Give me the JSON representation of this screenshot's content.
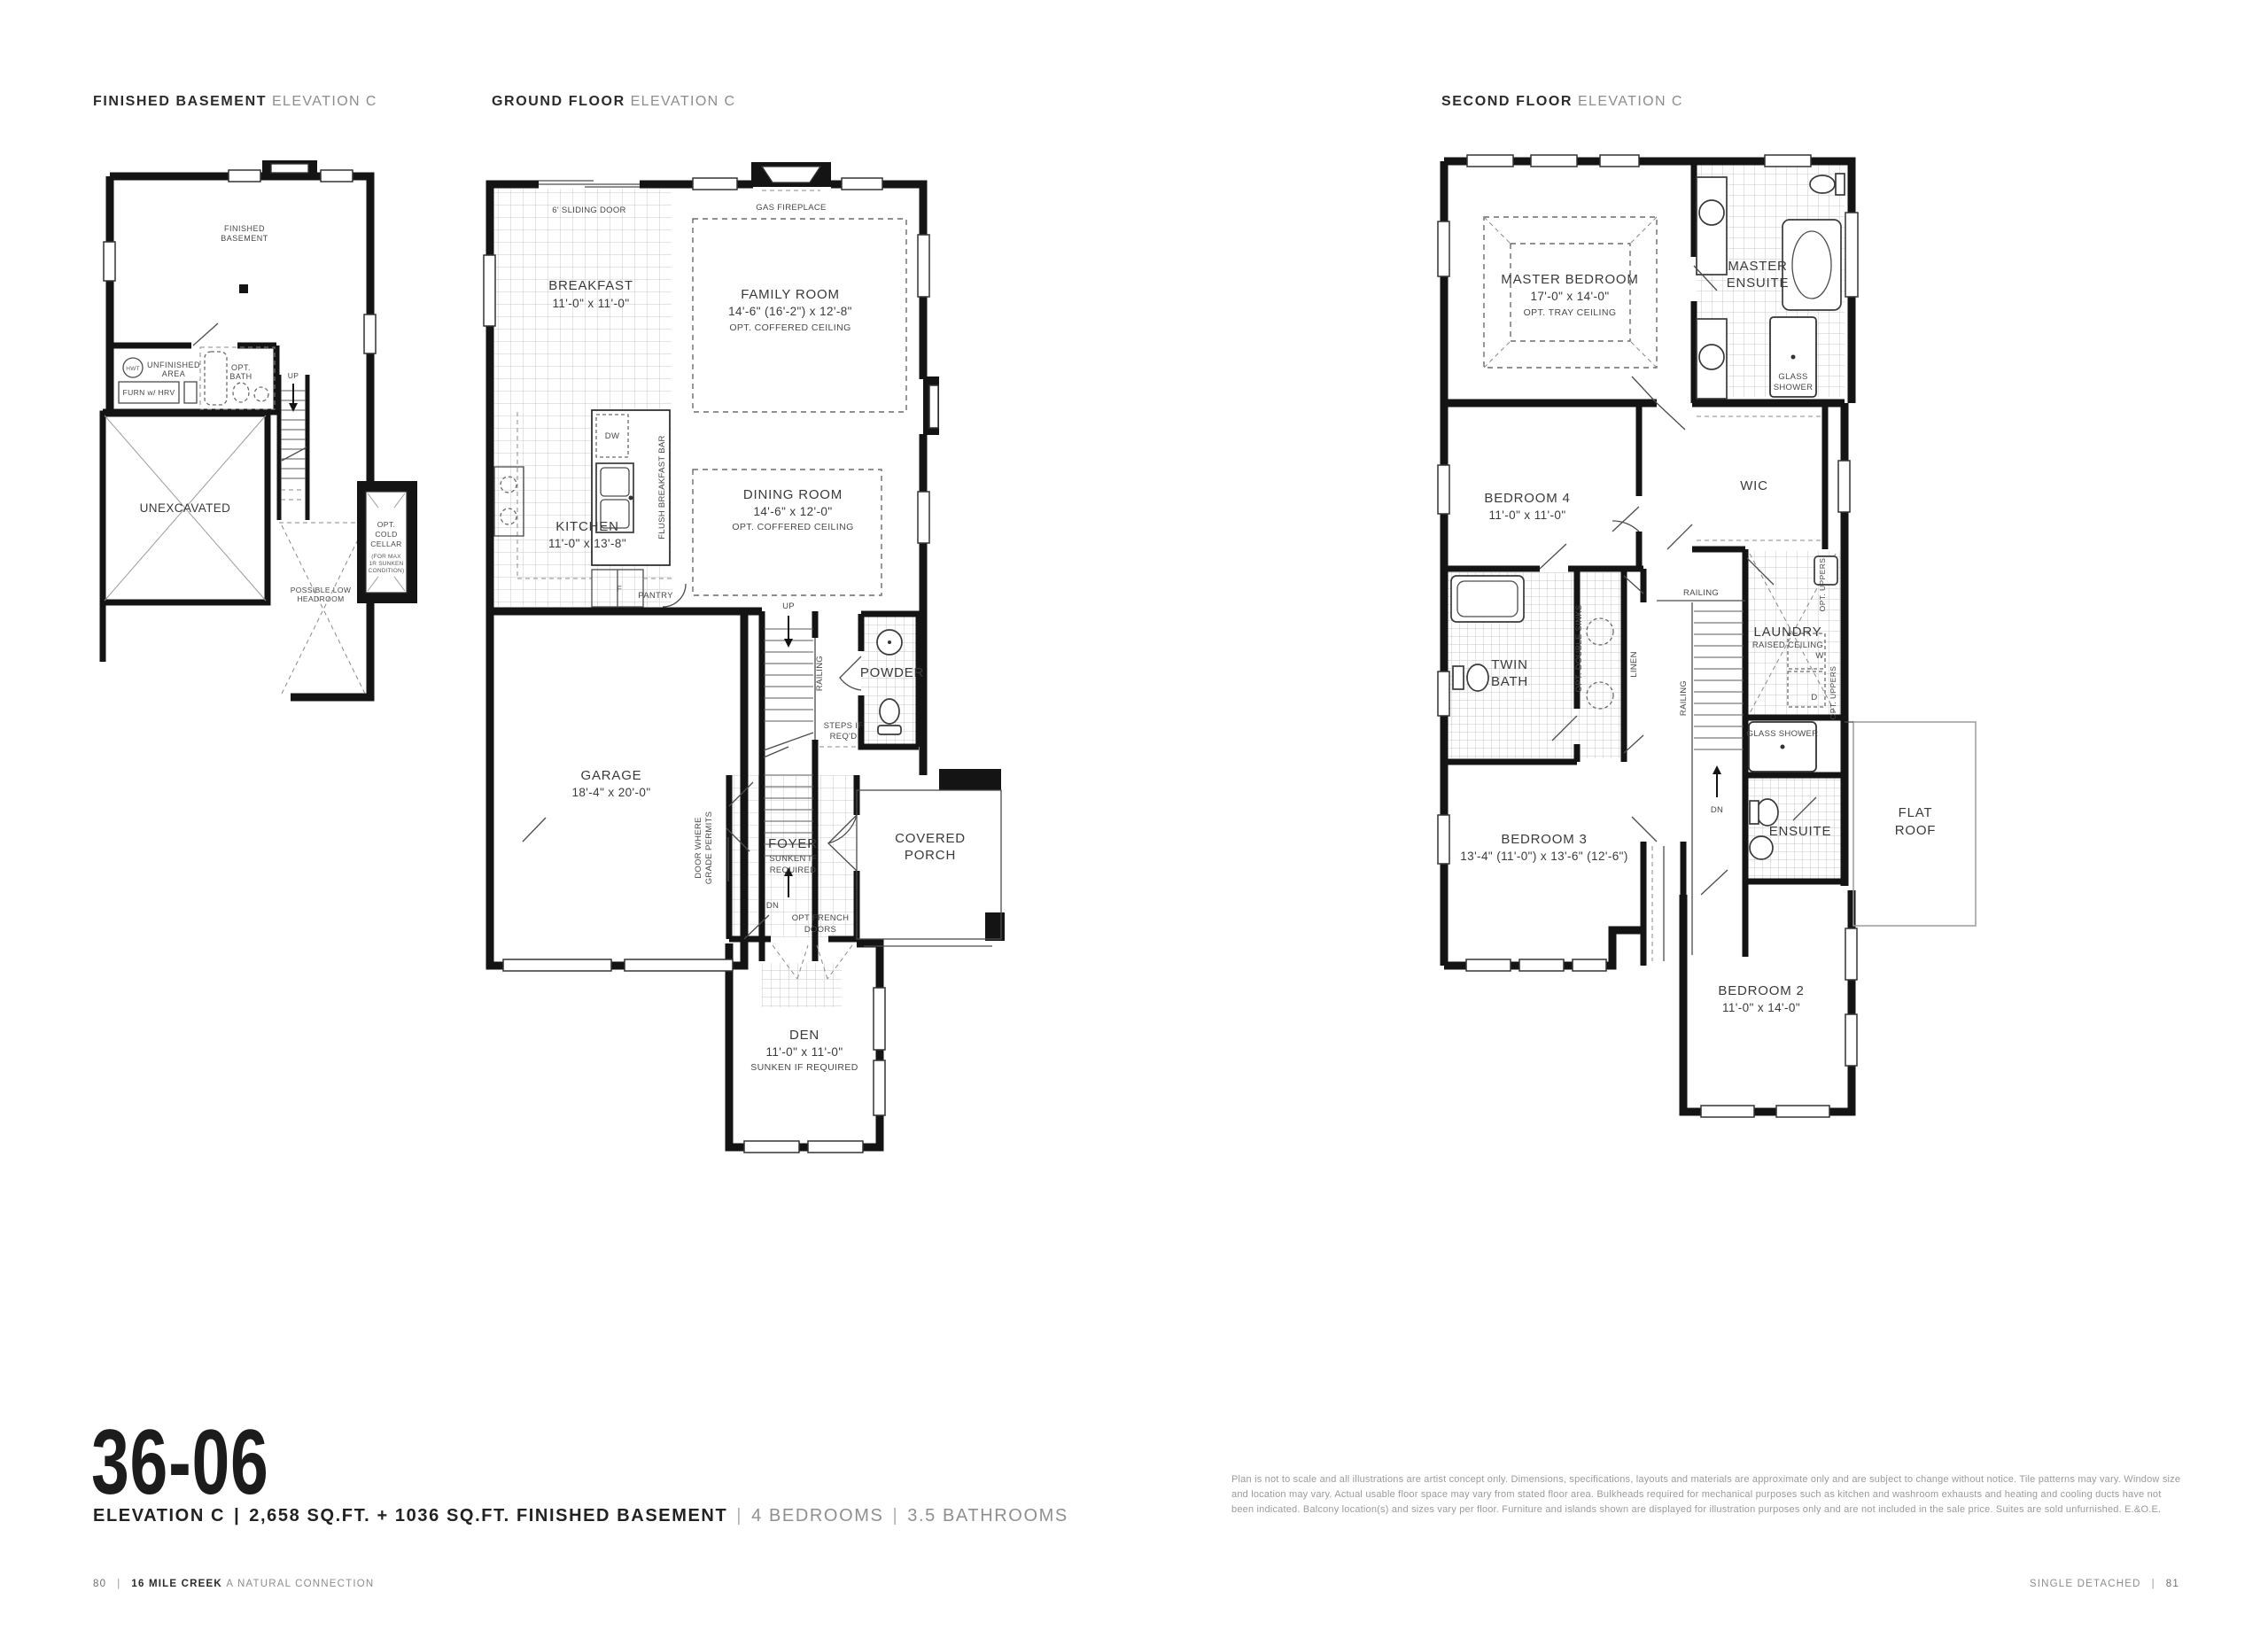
{
  "headers": {
    "basement": {
      "bold": "FINISHED BASEMENT",
      "light": "ELEVATION C"
    },
    "ground": {
      "bold": "GROUND FLOOR",
      "light": "ELEVATION C"
    },
    "second": {
      "bold": "SECOND FLOOR",
      "light": "ELEVATION C"
    }
  },
  "basement": {
    "room1": "FINISHED",
    "room1b": "BASEMENT",
    "unf1": "UNFINISHED",
    "unf2": "AREA",
    "hwt": "HWT",
    "furn": "FURN w/ HRV",
    "bath1": "OPT.",
    "bath2": "BATH",
    "up": "UP",
    "unexcavated": "UNEXCAVATED",
    "cc1": "OPT.",
    "cc2": "COLD",
    "cc3": "CELLAR",
    "ccn1": "(FOR MAX",
    "ccn2": "1R SUNKEN",
    "ccn3": "CONDITION)",
    "plh1": "POSSIBLE LOW",
    "plh2": "HEADROOM"
  },
  "ground": {
    "sliding_door": "6' SLIDING DOOR",
    "gas_fireplace": "GAS FIREPLACE",
    "breakfast": "BREAKFAST",
    "breakfast_dims": "11'-0\" x 11'-0\"",
    "family": "FAMILY ROOM",
    "family_dims": "14'-6\" (16'-2\") x 12'-8\"",
    "family_note": "OPT. COFFERED CEILING",
    "dw": "DW",
    "flush_bar": "FLUSH BREAKFAST BAR",
    "kitchen": "KITCHEN",
    "kitchen_dims": "11'-0\" x 13'-8\"",
    "fridge": "F",
    "pantry": "PANTRY",
    "dining": "DINING ROOM",
    "dining_dims": "14'-6\" x 12'-0\"",
    "dining_note": "OPT. COFFERED CEILING",
    "up": "UP",
    "dn": "DN",
    "railing": "RAILING",
    "powder": "POWDER",
    "steps1": "STEPS IF",
    "steps2": "REQ'D",
    "garage": "GARAGE",
    "garage_dims": "18'-4\" x 20'-0\"",
    "grade1": "DOOR WHERE",
    "grade2": "GRADE PERMITS",
    "foyer": "FOYER",
    "foyer_n1": "SUNKEN IF",
    "foyer_n2": "REQUIRED",
    "porch1": "COVERED",
    "porch2": "PORCH",
    "french1": "OPT FRENCH",
    "french2": "DOORS",
    "den": "DEN",
    "den_dims": "11'-0\" x 11'-0\"",
    "den_note": "SUNKEN IF REQUIRED"
  },
  "second": {
    "master": "MASTER BEDROOM",
    "master_dims": "17'-0\" x 14'-0\"",
    "master_note": "OPT. TRAY CEILING",
    "mens1": "MASTER",
    "mens2": "ENSUITE",
    "gs1": "GLASS",
    "gs2": "SHOWER",
    "wic": "WIC",
    "bed4": "BEDROOM 4",
    "bed4_dims": "11'-0\" x 11'-0\"",
    "twin1": "TWIN",
    "twin2": "BATH",
    "dbl_sinks": "OPT. DOUBLE SINKS",
    "linen": "LINEN",
    "railing_h": "RAILING",
    "railing_v": "RAILING",
    "laundry": "LAUNDRY",
    "laundry_note": "RAISED CEILING",
    "w": "W",
    "d": "D",
    "uppers1": "OPT. UPPERS",
    "uppers2": "OPT. UPPERS",
    "glass_shower": "GLASS SHOWER",
    "ensuite": "ENSUITE",
    "dn": "DN",
    "flat1": "FLAT",
    "flat2": "ROOF",
    "bed3": "BEDROOM 3",
    "bed3_dims": "13'-4\" (11'-0\") x 13'-6\" (12'-6\")",
    "bed2": "BEDROOM 2",
    "bed2_dims": "11'-0\" x 14'-0\""
  },
  "title_block": {
    "model": "36-06",
    "seg1": "ELEVATION C",
    "sep": "|",
    "seg2": "2,658 SQ.FT. + 1036 SQ.FT. FINISHED BASEMENT",
    "seg3": "4 BEDROOMS",
    "seg4": "3.5 BATHROOMS"
  },
  "disclaimer": "Plan is not to scale and all illustrations are artist concept only. Dimensions, specifications, layouts and materials are approximate only and are subject to change without notice. Tile patterns may vary. Window size and location may vary. Actual usable floor space may vary from stated floor area. Bulkheads required for mechanical purposes such as kitchen and washroom exhausts and heating and cooling ducts have not been indicated. Balcony location(s) and sizes vary per floor. Furniture and islands shown are displayed for illustration purposes only and are not included in the sale price. Suites are sold unfurnished. E.&O.E.",
  "footer": {
    "left_page": "80",
    "bar": "|",
    "left_bold": "16 MILE CREEK",
    "left_light": "A NATURAL CONNECTION",
    "right_text": "SINGLE DETACHED",
    "right_page": "81"
  }
}
